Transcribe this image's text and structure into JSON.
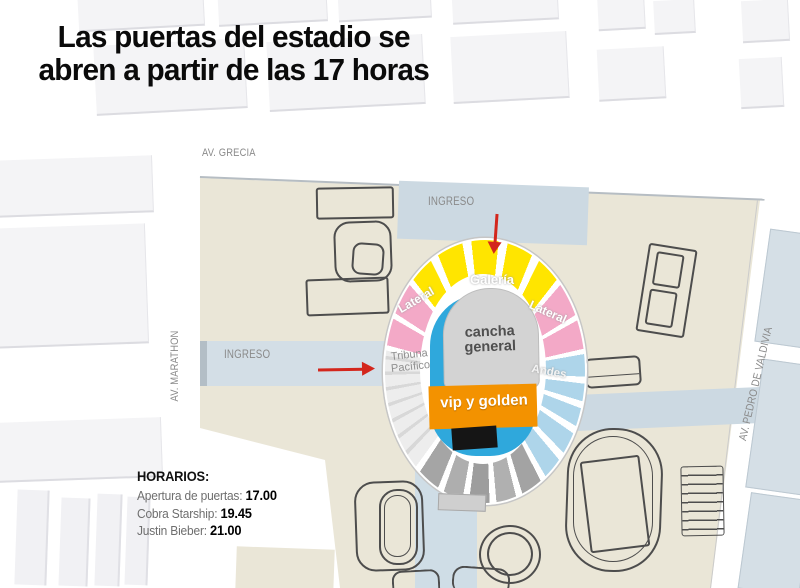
{
  "title": {
    "line1": "Las puertas del estadio se",
    "line2": "abren a partir de las 17 horas"
  },
  "map": {
    "streets": {
      "top": "AV. GRECIA",
      "left": "AV. MARATHON",
      "right": "AV. PEDRO DE VALDIVIA"
    },
    "entrances": {
      "top_label": "INGRESO",
      "left_label": "INGRESO"
    }
  },
  "stadium": {
    "sections": {
      "galeria": {
        "label": "Galería",
        "color": "#FFE500"
      },
      "lateral_left": {
        "label": "Lateral",
        "color": "#F3A9C7"
      },
      "lateral_right": {
        "label": "Lateral",
        "color": "#F3A9C7"
      },
      "andes": {
        "label": "Andes",
        "color": "#AED5EA"
      },
      "tribuna_pacifico": {
        "label_line1": "Tribuna",
        "label_line2": "Pacífico",
        "color": "#E8E8E8"
      },
      "cancha": {
        "label_line1": "cancha",
        "label_line2": "general",
        "color": "#D3D3D3"
      },
      "vip": {
        "label": "vip y golden",
        "color": "#F39200"
      },
      "stage_color": "#2FA8DC"
    }
  },
  "schedule": {
    "heading": "HORARIOS:",
    "items": [
      {
        "label": "Apertura de puertas: ",
        "time": "17.00"
      },
      {
        "label": "Cobra Starship: ",
        "time": "19.45"
      },
      {
        "label": "Justin Bieber: ",
        "time": "21.00"
      }
    ]
  },
  "colors": {
    "map_bg": "#EAE6D7",
    "street": "#CCD9E2",
    "arrow_red": "#D3261C"
  }
}
